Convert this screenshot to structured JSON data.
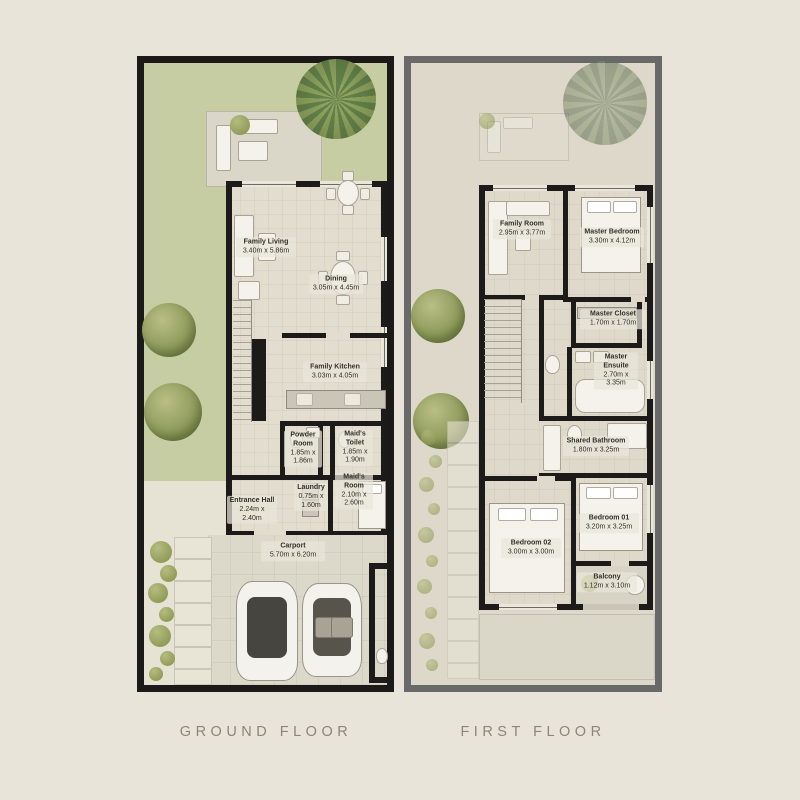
{
  "captions": {
    "ground": "GROUND FLOOR",
    "first": "FIRST FLOOR"
  },
  "ground_floor": {
    "rooms": [
      {
        "name": "Family Living",
        "dims": "3.40m x 5.86m"
      },
      {
        "name": "Dining",
        "dims": "3.05m x 4.45m"
      },
      {
        "name": "Family Kitchen",
        "dims": "3.03m x 4.05m"
      },
      {
        "name": "Powder Room",
        "dims": "1.85m x 1.86m"
      },
      {
        "name": "Maid's Toilet",
        "dims": "1.85m x 1.90m"
      },
      {
        "name": "Maid's Room",
        "dims": "2.10m x 2.60m"
      },
      {
        "name": "Laundry",
        "dims": "0.75m x 1.60m"
      },
      {
        "name": "Entrance Hall",
        "dims": "2.24m x 2.40m"
      },
      {
        "name": "Carport",
        "dims": "5.70m x 6.20m"
      }
    ]
  },
  "first_floor": {
    "rooms": [
      {
        "name": "Family Room",
        "dims": "2.95m x 3.77m"
      },
      {
        "name": "Master Bedroom",
        "dims": "3.30m x 4.12m"
      },
      {
        "name": "Master Closet",
        "dims": "1.70m x 1.70m"
      },
      {
        "name": "Master Ensuite",
        "dims": "2.70m x 3.35m"
      },
      {
        "name": "Shared Bathroom",
        "dims": "1.80m x 3.25m"
      },
      {
        "name": "Bedroom 01",
        "dims": "3.20m x 3.25m"
      },
      {
        "name": "Bedroom 02",
        "dims": "3.00m x 3.00m"
      },
      {
        "name": "Balcony",
        "dims": "1.12m x 3.10m"
      }
    ]
  },
  "colors": {
    "page_background": "#e9e4da",
    "ground_frame": "#1b1a18",
    "first_frame": "#69696a",
    "lawn": "#c7cda3",
    "floor_tile": "#e2ddcf",
    "wall": "#1c1b19",
    "caption_text": "#8f8478",
    "tree_green": "#909c5c"
  },
  "icons": {
    "tree": "green radial blob",
    "palm-tree": "conic starburst blob",
    "shrub": "small olive circle",
    "car": "rounded rect top view",
    "bed": "rect with pillows",
    "bathtub": "rounded rect outline",
    "toilet": "small white oval",
    "dining-table": "ellipse with chairs"
  }
}
